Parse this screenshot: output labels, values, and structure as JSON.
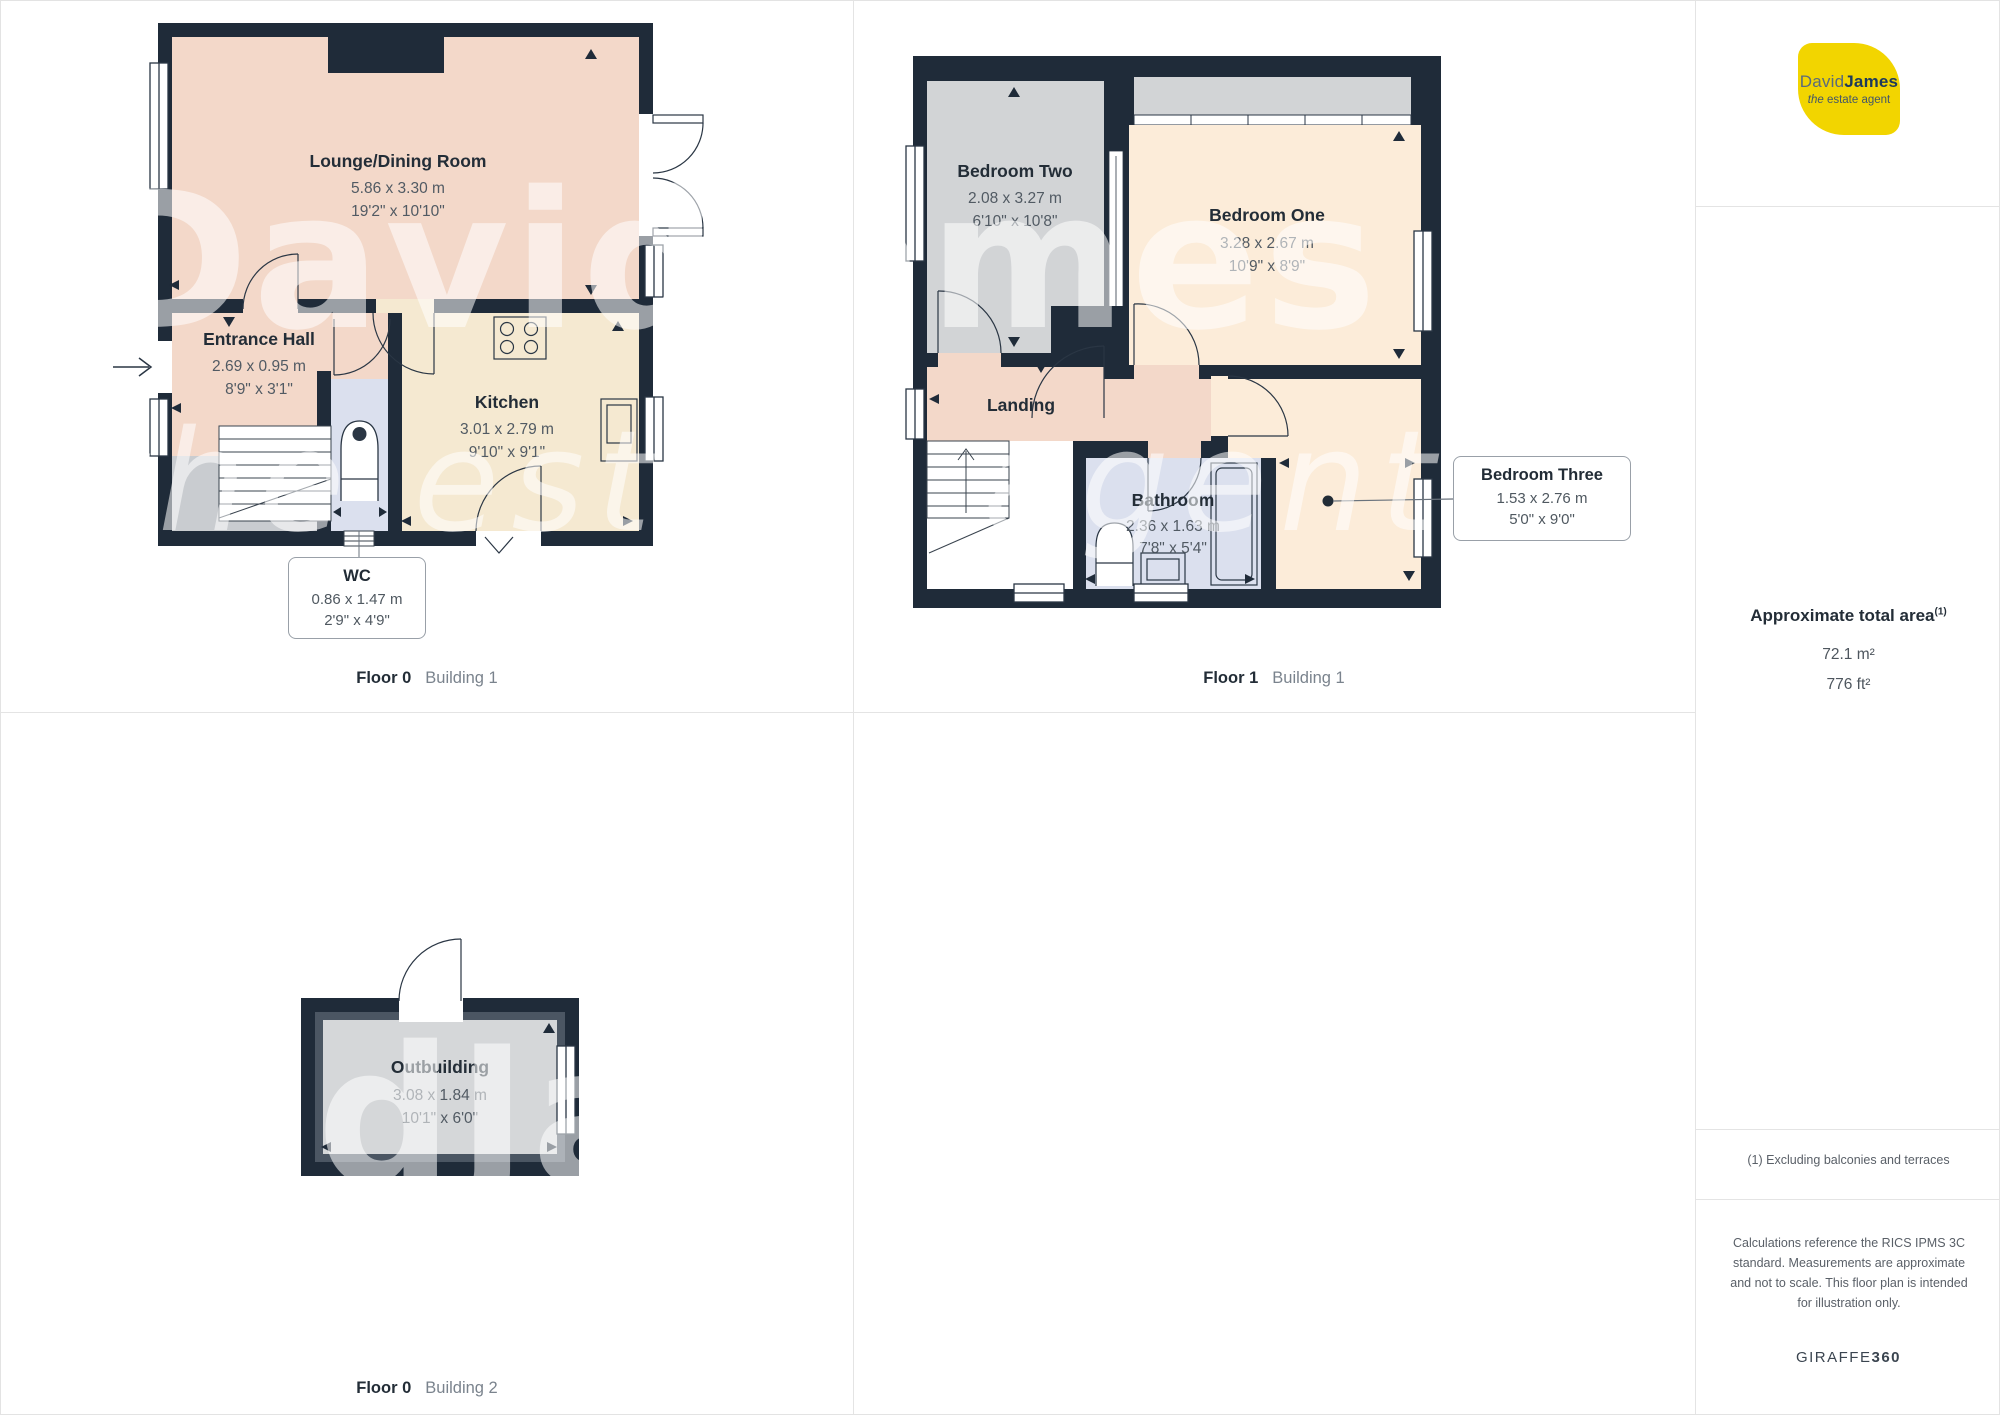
{
  "watermark": {
    "brand": "DavidJames",
    "tagline": "the estate agent"
  },
  "floor0_building1": {
    "label_floor": "Floor 0",
    "label_building": "Building 1",
    "lounge": {
      "name": "Lounge/Dining Room",
      "metric": "5.86 x 3.30 m",
      "imperial": "19'2\" x 10'10\""
    },
    "hall": {
      "name": "Entrance Hall",
      "metric": "2.69 x 0.95 m",
      "imperial": "8'9\" x 3'1\""
    },
    "kitchen": {
      "name": "Kitchen",
      "metric": "3.01 x 2.79 m",
      "imperial": "9'10\" x 9'1\""
    },
    "wc": {
      "name": "WC",
      "metric": "0.86 x 1.47 m",
      "imperial": "2'9\" x 4'9\""
    }
  },
  "floor1_building1": {
    "label_floor": "Floor 1",
    "label_building": "Building 1",
    "bedroom_two": {
      "name": "Bedroom Two",
      "metric": "2.08 x 3.27 m",
      "imperial": "6'10\" x 10'8\""
    },
    "bedroom_one": {
      "name": "Bedroom One",
      "metric": "3.28 x 2.67 m",
      "imperial": "10'9\" x 8'9\""
    },
    "landing": {
      "name": "Landing"
    },
    "bathroom": {
      "name": "Bathroom",
      "metric": "2.36 x 1.63 m",
      "imperial": "7'8\" x 5'4\""
    },
    "bedroom_three": {
      "name": "Bedroom Three",
      "metric": "1.53 x 2.76 m",
      "imperial": "5'0\" x 9'0\""
    }
  },
  "floor0_building2": {
    "label_floor": "Floor 0",
    "label_building": "Building 2",
    "outbuilding": {
      "name": "Outbuilding",
      "metric": "3.08 x 1.84 m",
      "imperial": "10'1\" x 6'0\""
    }
  },
  "sidebar": {
    "logo": {
      "brand_light": "David",
      "brand_bold": "James",
      "tagline_italic": "the",
      "tagline_rest": " estate agent"
    },
    "area": {
      "title": "Approximate total area",
      "superscript": "(1)",
      "metric": "72.1 m²",
      "imperial": "776 ft²"
    },
    "footnote": "(1) Excluding balconies and terraces",
    "disclaimer": "Calculations reference the RICS IPMS 3C standard. Measurements are approximate and not to scale. This floor plan is intended for illustration only.",
    "brand_footer": {
      "name": "GIRAFFE",
      "suffix": "360"
    }
  },
  "colors": {
    "wall": "#1f2b39",
    "pink": "#f3d8c9",
    "kitchen": "#f5e9d1",
    "cream": "#fcecd9",
    "gray": "#d2d4d6",
    "blue": "#dbe0ee",
    "logo_yellow": "#f2d500"
  }
}
